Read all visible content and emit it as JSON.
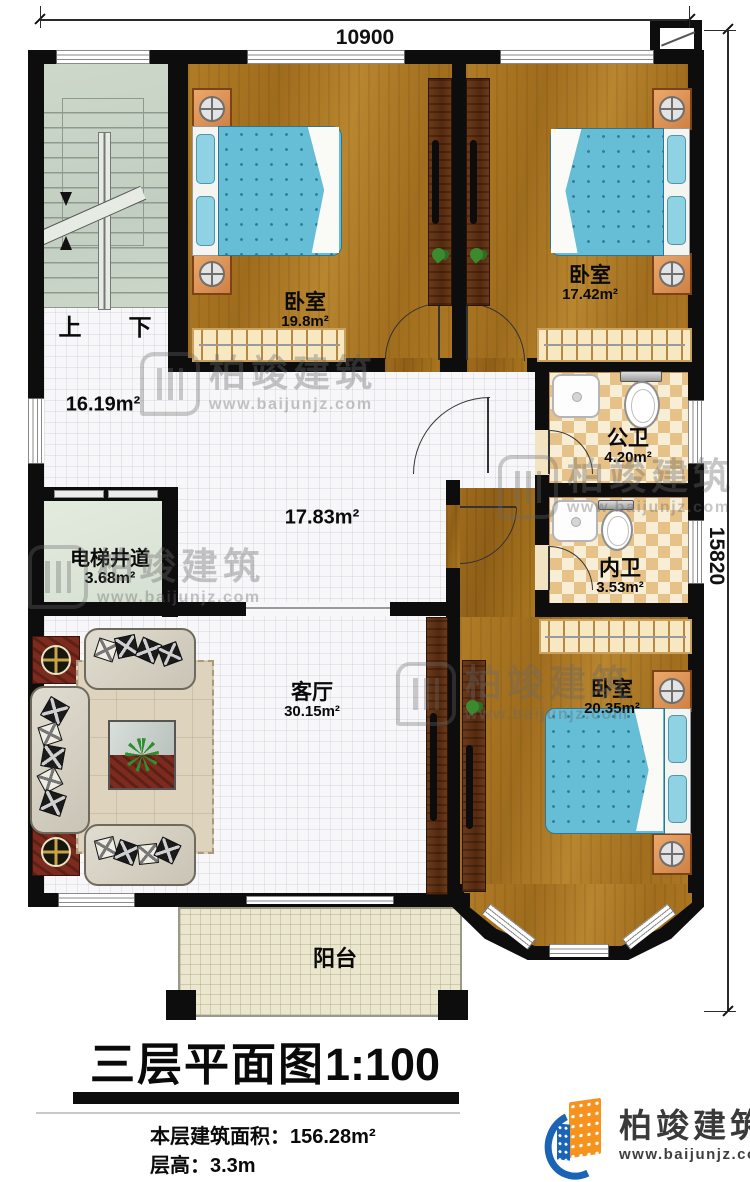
{
  "title": {
    "main": "三层平面图",
    "scale": "1:100"
  },
  "footer": {
    "area_line": "本层建筑面积：156.28m²",
    "height_line": "层高：3.3m"
  },
  "brand": {
    "name": "柏竣建筑",
    "url": "www.baijunjz.com"
  },
  "watermark": {
    "name": "柏竣建筑",
    "url": "www.baijunjz.com"
  },
  "dimensions": {
    "width": "10900",
    "height": "15820"
  },
  "rooms": {
    "bedroom1": {
      "name": "卧室",
      "area": "19.8m²"
    },
    "bedroom2": {
      "name": "卧室",
      "area": "17.42m²"
    },
    "bedroom3": {
      "name": "卧室",
      "area": "20.35m²"
    },
    "public_bath": {
      "name": "公卫",
      "area": "4.20m²"
    },
    "ensuite_bath": {
      "name": "内卫",
      "area": "3.53m²"
    },
    "living": {
      "name": "客厅",
      "area": "30.15m²"
    },
    "elevator": {
      "name": "电梯井道",
      "area": "3.68m²"
    },
    "balcony": {
      "name": "阳台"
    },
    "hall": {
      "area": "16.19m²"
    },
    "corridor": {
      "area": "17.83m²"
    },
    "stairs": {
      "up": "上",
      "down": "下"
    }
  },
  "colors": {
    "wall": "#0d0d0d",
    "wood_floor": "#aa761f",
    "tile": "#f7f7f9",
    "bath_tile": "#e7c288",
    "bed_blue": "#66bdd6",
    "stair_green": "#c9d4c6",
    "balcony_cream": "#ebe7cf",
    "logo_blue": "#1b63b5",
    "logo_orange": "#f6921e"
  }
}
